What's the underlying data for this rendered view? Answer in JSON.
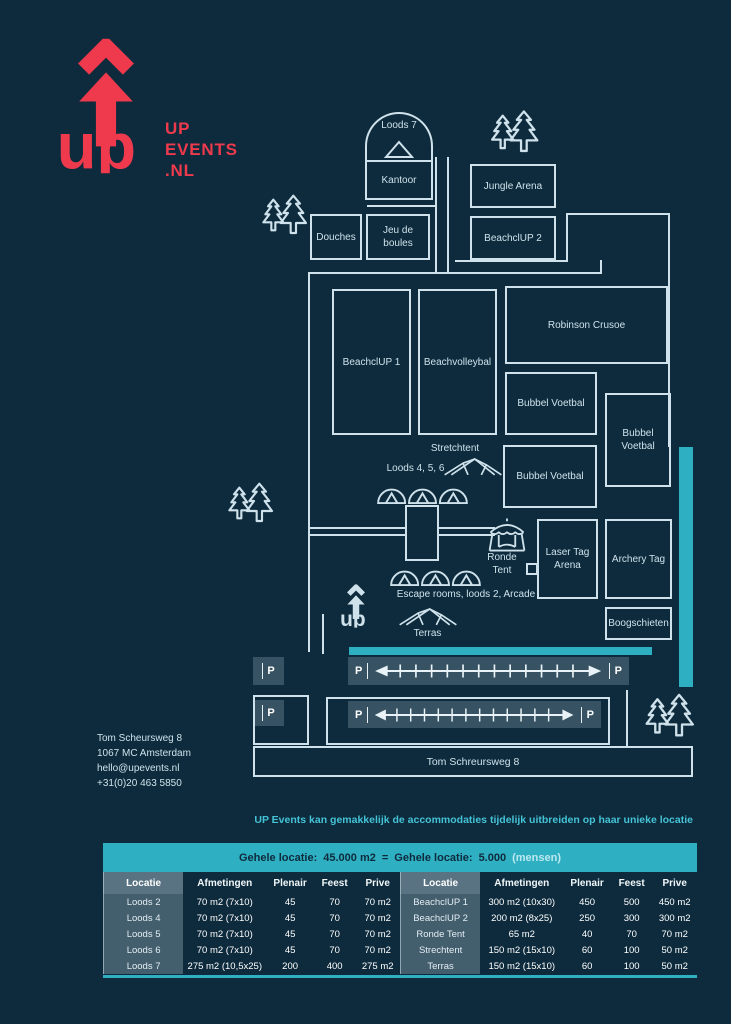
{
  "colors": {
    "accent": "#2fafc2",
    "red": "#ee3a4c",
    "line": "#cfe2eb",
    "background": "#0d2b3d"
  },
  "logo": {
    "word": "up",
    "line1": "UP",
    "line2": "EVENTS",
    "line3": ".NL"
  },
  "contact": {
    "lines": [
      "Tom Scheursweg 8",
      "1067 MC Amsterdam",
      "hello@upevents.nl",
      "+31(0)20 463 5850"
    ]
  },
  "map": {
    "loods7": {
      "label": "Loods 7"
    },
    "rooms": [
      {
        "id": "kantoor",
        "label": "Kantoor",
        "x": 365,
        "y": 160,
        "w": 68,
        "h": 40
      },
      {
        "id": "jungle-arena",
        "label": "Jungle Arena",
        "x": 470,
        "y": 164,
        "w": 86,
        "h": 44
      },
      {
        "id": "beachclup-2",
        "label": "BeachclUP 2",
        "x": 470,
        "y": 216,
        "w": 86,
        "h": 44
      },
      {
        "id": "douches",
        "label": "Douches",
        "x": 310,
        "y": 214,
        "w": 52,
        "h": 46
      },
      {
        "id": "jeu-de-boules",
        "label": "Jeu de boules",
        "x": 366,
        "y": 214,
        "w": 64,
        "h": 46
      },
      {
        "id": "beachclup-1",
        "label": "BeachclUP 1",
        "x": 332,
        "y": 289,
        "w": 79,
        "h": 146
      },
      {
        "id": "beachvolleybal",
        "label": "Beachvolleybal",
        "x": 418,
        "y": 289,
        "w": 79,
        "h": 146
      },
      {
        "id": "robinson-crusoe",
        "label": "Robinson Crusoe",
        "x": 505,
        "y": 286,
        "w": 163,
        "h": 78
      },
      {
        "id": "bubbel-voetbal-1",
        "label": "Bubbel Voetbal",
        "x": 505,
        "y": 372,
        "w": 92,
        "h": 63
      },
      {
        "id": "bubbel-voetbal-2",
        "label": "Bubbel Voetbal",
        "x": 605,
        "y": 393,
        "w": 66,
        "h": 94
      },
      {
        "id": "bubbel-voetbal-3",
        "label": "Bubbel Voetbal",
        "x": 503,
        "y": 445,
        "w": 94,
        "h": 63
      },
      {
        "id": "laser-tag-arena",
        "label": "Laser Tag Arena",
        "x": 537,
        "y": 519,
        "w": 61,
        "h": 80
      },
      {
        "id": "archery-tag",
        "label": "Archery Tag",
        "x": 605,
        "y": 519,
        "w": 67,
        "h": 80
      },
      {
        "id": "boogschieten",
        "label": "Boogschieten",
        "x": 605,
        "y": 607,
        "w": 67,
        "h": 33
      }
    ],
    "labels": [
      {
        "id": "stretchtent",
        "text": "Stretchtent",
        "x": 413,
        "y": 443,
        "w": 84
      },
      {
        "id": "loods-4-5-6",
        "text": "Loods 4, 5, 6",
        "x": 368,
        "y": 463,
        "w": 95
      },
      {
        "id": "ronde-tent",
        "text": "Ronde Tent",
        "x": 477,
        "y": 552,
        "w": 50
      },
      {
        "id": "escape-rooms-loods2-arcade",
        "text": "Escape rooms, loods 2, Arcade",
        "x": 368,
        "y": 589,
        "w": 196
      },
      {
        "id": "terras",
        "text": "Terras",
        "x": 400,
        "y": 628,
        "w": 55
      }
    ],
    "street_label": "Tom Schreursweg 8",
    "parking_p": "P"
  },
  "footer": {
    "intro": "UP Events kan gemakkelijk de accommodaties tijdelijk uitbreiden op haar unieke locatie"
  },
  "table": {
    "header": {
      "part1": "Gehele locatie:",
      "value1": "45.000 m2",
      "eq": "=",
      "part2": "Gehele locatie:",
      "value2": "5.000",
      "suffix": "(mensen)"
    },
    "columns": [
      "Locatie",
      "Afmetingen",
      "Plenair",
      "Feest",
      "Prive"
    ],
    "left_rows": [
      [
        "Loods 2",
        "70 m2 (7x10)",
        "45",
        "70",
        "70 m2"
      ],
      [
        "Loods 4",
        "70 m2 (7x10)",
        "45",
        "70",
        "70 m2"
      ],
      [
        "Loods 5",
        "70 m2 (7x10)",
        "45",
        "70",
        "70 m2"
      ],
      [
        "Loods 6",
        "70 m2 (7x10)",
        "45",
        "70",
        "70 m2"
      ],
      [
        "Loods 7",
        "275 m2 (10,5x25)",
        "200",
        "400",
        "275 m2"
      ]
    ],
    "right_rows": [
      [
        "BeachclUP 1",
        "300 m2 (10x30)",
        "450",
        "500",
        "450 m2"
      ],
      [
        "BeachclUP 2",
        "200 m2 (8x25)",
        "250",
        "300",
        "300 m2"
      ],
      [
        "Ronde Tent",
        "65 m2",
        "40",
        "70",
        "70 m2"
      ],
      [
        "Strechtent",
        "150 m2 (15x10)",
        "60",
        "100",
        "50 m2"
      ],
      [
        "Terras",
        "150 m2 (15x10)",
        "60",
        "100",
        "50 m2"
      ]
    ]
  }
}
